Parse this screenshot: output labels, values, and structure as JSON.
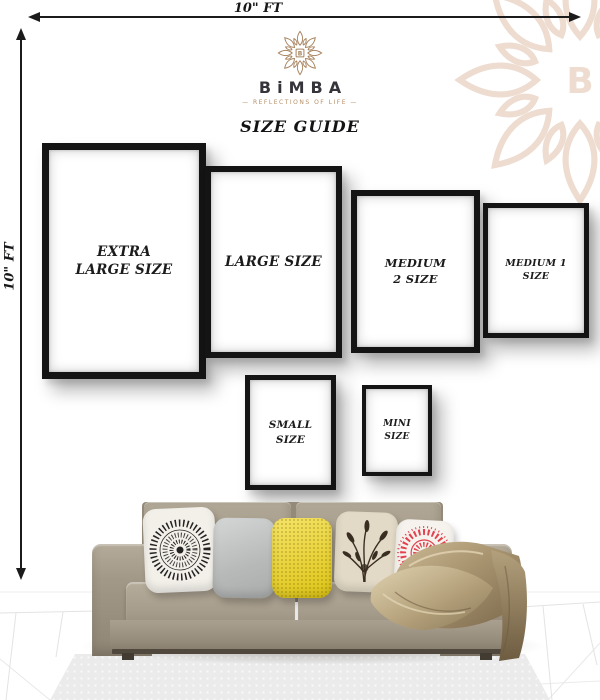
{
  "dimension_arrows": {
    "top_label": "10\" FT",
    "left_label": "10\" FT"
  },
  "brand": {
    "wordmark": "BiMBA",
    "monogram": "B",
    "tagline": "— REFLECTIONS OF LIFE —",
    "logo_color": "#a8835f",
    "watermark_color": "#ecd9ca"
  },
  "heading": "SIZE GUIDE",
  "frames": [
    {
      "label": "EXTRA LARGE SIZE"
    },
    {
      "label": "LARGE SIZE"
    },
    {
      "label": "MEDIUM 2 SIZE"
    },
    {
      "label": "MEDIUM 1 SIZE"
    },
    {
      "label": "SMALL SIZE"
    },
    {
      "label": "MINI SIZE"
    }
  ],
  "scene": {
    "sofa_color": "#a59b8a",
    "throw_color": "#9a8565",
    "pillow_colors": {
      "mandala": "#f2f0e9",
      "gray": "#c3c7c6",
      "yellow": "#f0d517",
      "floral": "#e2dac6",
      "red_accent": "#e2414e"
    }
  }
}
